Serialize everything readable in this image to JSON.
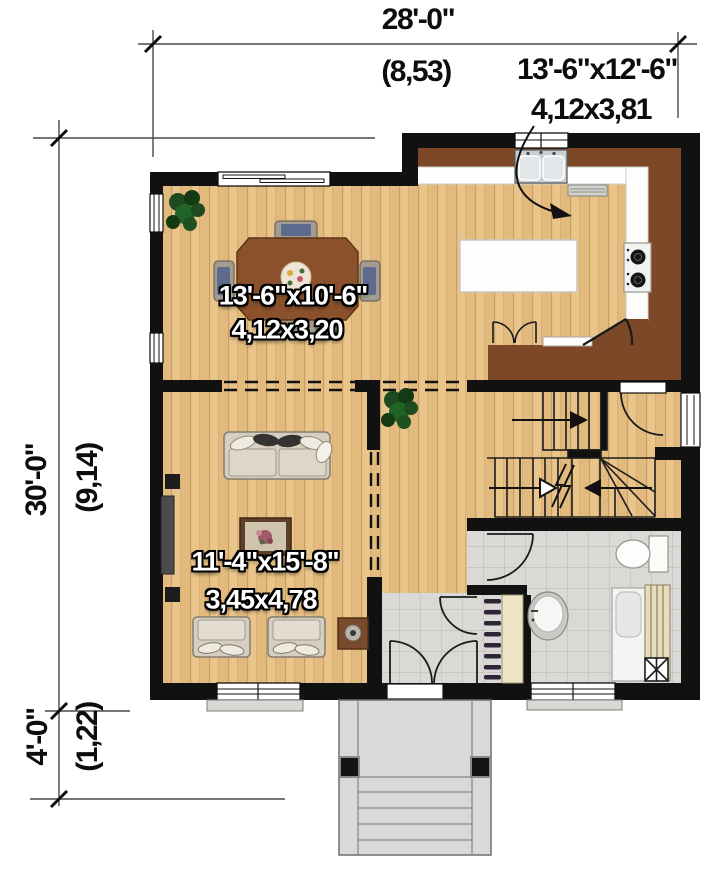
{
  "annotations": {
    "overall_width": {
      "imperial": "28'-0\"",
      "metric": "(8,53)"
    },
    "overall_depth": {
      "imperial": "30'-0\"",
      "metric": "(9,14)"
    },
    "porch_depth": {
      "imperial": "4'-0\"",
      "metric": "(1,22)"
    },
    "kitchen_size": {
      "imperial": "13'-6\"x12'-6\"",
      "metric": "4,12x3,81"
    },
    "dining_size": {
      "imperial": "13'-6\"x10'-6\"",
      "metric": "4,12x3,20"
    },
    "living_size": {
      "imperial": "11'-4\"x15'-8\"",
      "metric": "3,45x4,78"
    }
  },
  "colors": {
    "wall": "#111111",
    "wood_floor": "#e8c48c",
    "counter_brown": "#7c4828",
    "tile": "#dad8d4",
    "porch": "#d7dad6",
    "label_text": "#ffffff",
    "dimension_text": "#0d0d0d"
  }
}
